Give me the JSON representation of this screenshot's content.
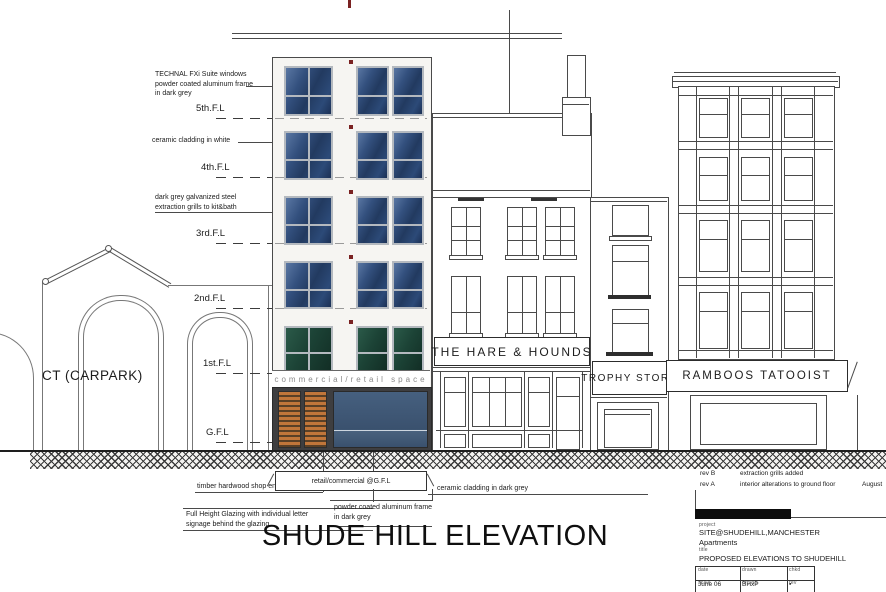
{
  "colors": {
    "line": "#4a4a4a",
    "facade_white": "#f6f5f2",
    "window_blue_dark": "#223a60",
    "window_blue_light": "#5a77a3",
    "window_green_dark": "#122e25",
    "frame_grey": "#b4b9bf",
    "timber_orange": "#c1763a",
    "storefront_grey": "#3e3e40",
    "marker_red": "#7a2222"
  },
  "floors": [
    {
      "label": "5th.F.L"
    },
    {
      "label": "4th.F.L"
    },
    {
      "label": "3rd.F.L"
    },
    {
      "label": "2nd.F.L"
    },
    {
      "label": "1st.F.L"
    },
    {
      "label": "G.F.L"
    }
  ],
  "annotations": {
    "technal_l1": "TECHNAL FXi Suite windows",
    "technal_l2": "powder coated aluminum frame",
    "technal_l3": "in dark grey",
    "ceramic_white": "ceramic cladding in white",
    "grills_l1": "dark grey galvanized steel",
    "grills_l2": "extraction grills to kit&bath",
    "timber": "timber hardwood shop entrance",
    "glazing_l1": "Full Height Glazing with individual letter",
    "glazing_l2": "signage behind the glazing",
    "frame_l1": "powder coated aluminum frame",
    "frame_l2": "in dark grey",
    "ceramic_dark": "ceramic cladding in dark grey",
    "banner": "retail/commercial @G.F.L"
  },
  "labels": {
    "carpark": "CT (CARPARK)",
    "retail_band": "commercial/retail space",
    "main_title": "SHUDE HILL ELEVATION"
  },
  "signs": {
    "pub": "THE HARE & HOUNDS",
    "trophy": "TROPHY STORE",
    "tattooist": "RAMBOOS TATOOIST"
  },
  "title_block": {
    "rev_b_tag": "rev B",
    "rev_b_text": "extraction grills added",
    "rev_a_tag": "rev A",
    "rev_a_text": "interior alterations to ground floor",
    "rev_a_date": "August",
    "project_label": "project",
    "project_line1": "SITE@SHUDEHILL,MANCHESTER",
    "project_line2": "Apartments",
    "title_label": "title",
    "drawing_title": "PROPOSED ELEVATIONS TO SHUDEHILL",
    "table": {
      "date_label": "date",
      "date": "June 06",
      "drawn_label": "drawn",
      "drawn": "BHxP",
      "checked_label": "chkd",
      "checked": "▪",
      "scale_label": "scale",
      "scale": "1:100A3",
      "dwg_label": "drg no",
      "dwg": "205/09",
      "rev_label": "rev",
      "rev": "C"
    }
  }
}
